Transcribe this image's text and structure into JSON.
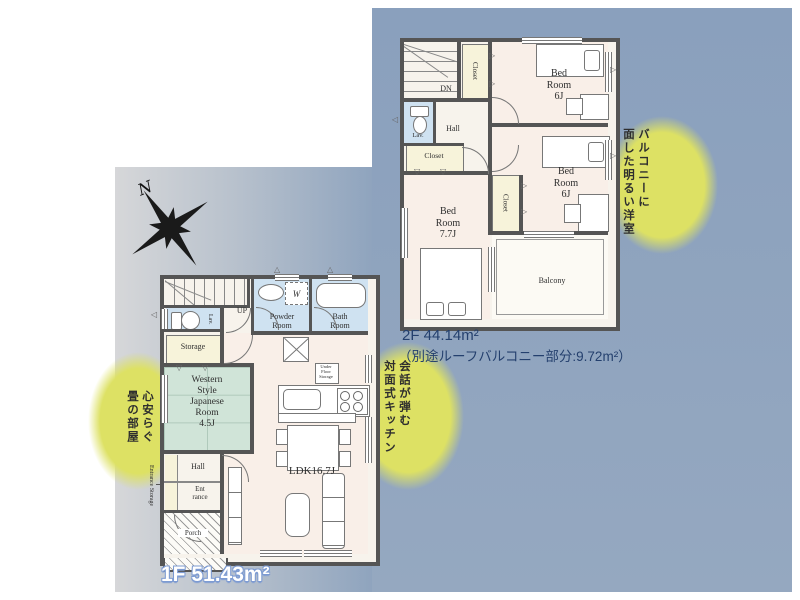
{
  "compass": {
    "north_label": "N"
  },
  "floor1": {
    "area_label": "1F 51.43m²",
    "rooms": {
      "stairs": "UP",
      "lavatory": "Lav.",
      "powder_room": "Powder\nRoom",
      "washing_machine": "W",
      "bath_room": "Bath\nRoom",
      "storage": "Storage",
      "western_room": "Western\nStyle\nJapanese\nRoom\n4.5J",
      "hall": "Hall",
      "entrance": "Ent\nrance",
      "entrance_storage": "Entrance Storage",
      "porch": "Porch",
      "ldk": "LDK16.7J",
      "under_floor_storage": "Under\nFloor\nStorage"
    }
  },
  "floor2": {
    "area_label": "2F 44.14m²",
    "area_note": "（別途ルーフバルコニー部分:9.72m²）",
    "rooms": {
      "stairs": "DN",
      "hall": "Hall",
      "lavatory": "Lav.",
      "closet_top": "Closet",
      "closet_left": "Closet",
      "closet_middle": "Closet",
      "bedroom_north": "Bed\nRoom\n6J",
      "bedroom_east": "Bed\nRoom\n6J",
      "bedroom_south": "Bed\nRoom\n7.7J",
      "balcony": "Balcony"
    }
  },
  "annotations": {
    "bright_room": "バルコニーに\n面した明るい洋室",
    "tatami_room": "心安らぐ\n畳の部屋",
    "kitchen": "会話が弾む\n対面式キッチン"
  },
  "icons": {
    "closet_mark_down": "▽",
    "closet_mark_right": "▷",
    "vent_up": "△",
    "vent_left": "◁",
    "vent_right": "▷"
  },
  "colors": {
    "background_blue": "#8ea3bd",
    "background_gray": "#d6d7d9",
    "highlight_yellow": "#dde164",
    "room_pink": "#f9efe8",
    "room_blue": "#cfe2f1",
    "room_cream": "#f7f3da",
    "room_green": "#d0e4d8",
    "wall": "#555555",
    "area_label_navy": "#24406e",
    "area_label_outline_blue": "#7d9bd2"
  }
}
